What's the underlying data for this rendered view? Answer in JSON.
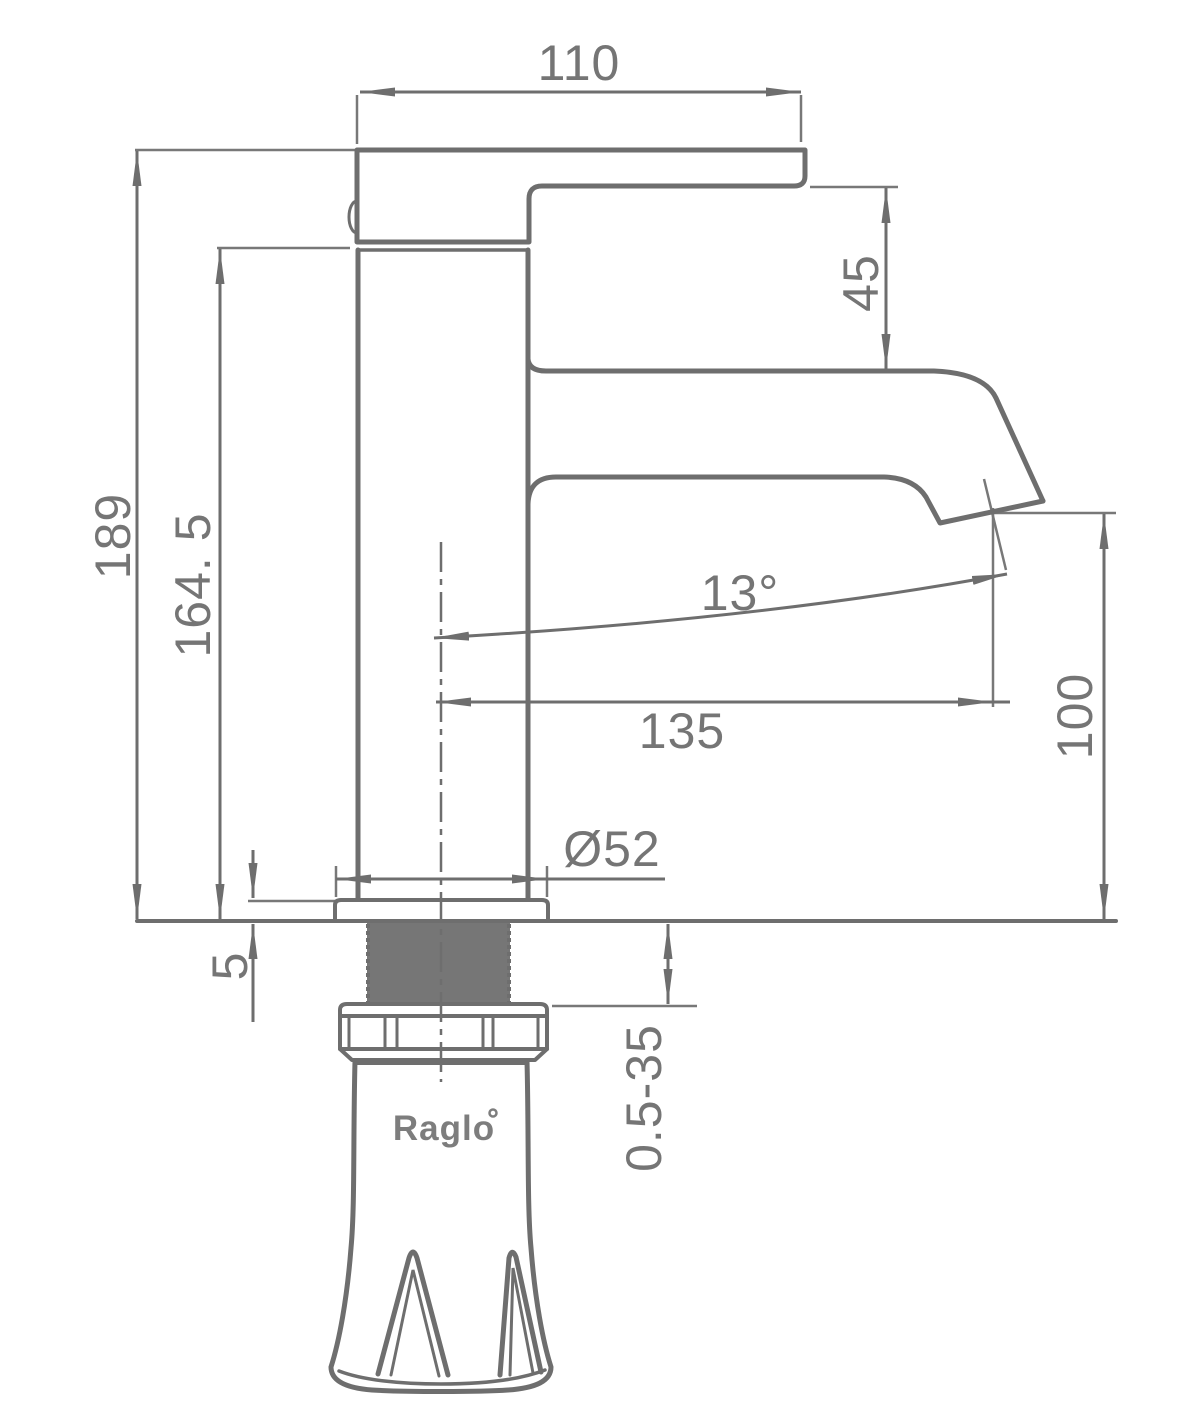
{
  "drawing": {
    "type": "technical-dimension-drawing",
    "subject": "basin faucet side elevation",
    "brand": "Raglo",
    "dimensions": {
      "spout_top_width": "110",
      "overall_height": "189",
      "body_height": "164. 5",
      "spout_section_height": "45",
      "spout_angle": "13°",
      "spout_reach": "135",
      "outlet_height": "100",
      "base_diameter": "Ø52",
      "flange_thickness": "5",
      "mounting_thickness_range": "0.5-35"
    },
    "colors": {
      "line": "#6e6e6e",
      "label_text": "#757575",
      "thread_fill": "#767676",
      "background": "#ffffff"
    }
  }
}
